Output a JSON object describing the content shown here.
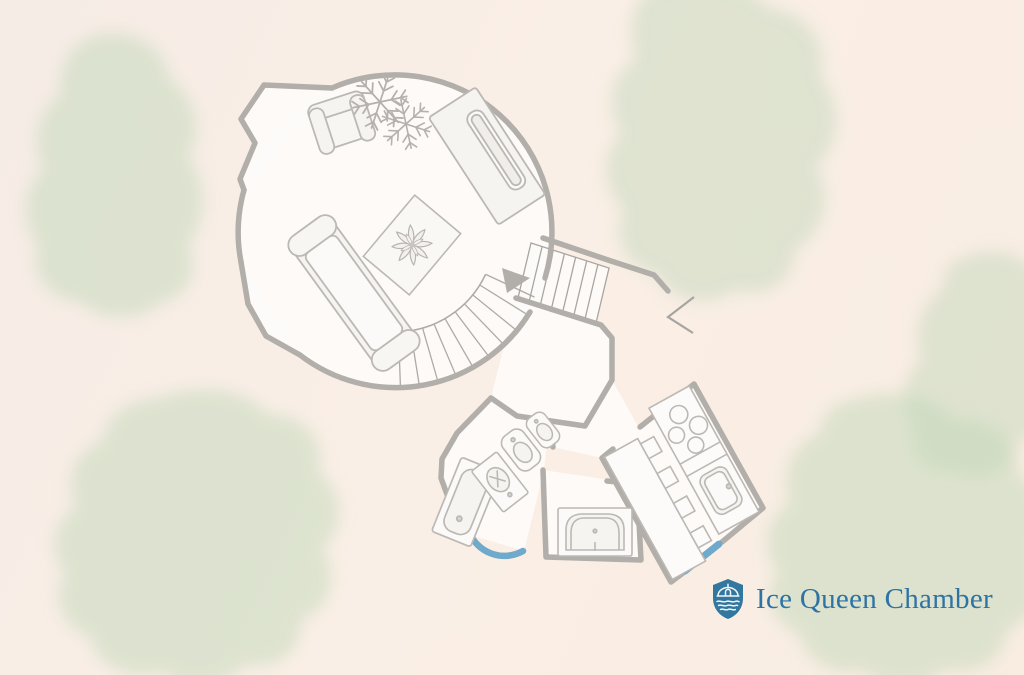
{
  "branding": {
    "logo_text": "Ice Queen Chamber",
    "logo_icon": "shield-house-crest-icon",
    "logo_text_color": "#2d73a3",
    "logo_shield_color": "#32779f"
  },
  "floor_plan": {
    "name": "Ice Queen Chamber floor plan",
    "style": "hand-drawn architectural sketch with watercolor foliage background",
    "rooms": [
      {
        "name": "main-circular-chamber",
        "shape": "circle",
        "furniture": [
          "armchair",
          "double-snowflake-decoration",
          "bed-with-runner",
          "diamond-area-rug-with-poinsettia",
          "chaise-sofa",
          "curved-staircase"
        ]
      },
      {
        "name": "entry-vestibule",
        "shape": "angular-alcove",
        "furniture": []
      },
      {
        "name": "entry-hall",
        "shape": "irregular-pentagon",
        "furniture": [
          "straight-staircase",
          "entry-door-swing"
        ]
      },
      {
        "name": "bathroom",
        "furniture": [
          "shower",
          "vanity-sink",
          "toilet",
          "bidet"
        ]
      },
      {
        "name": "bath-nook",
        "furniture": [
          "bathtub"
        ]
      },
      {
        "name": "kitchen",
        "furniture": [
          "four-burner-stove",
          "kitchen-sink",
          "prep-counter-with-cabinet-handles"
        ]
      }
    ],
    "markers": [
      "stair-direction-arrow",
      "blue-door-swing-bathroom",
      "blue-doorway-kitchen"
    ],
    "colors": {
      "wall": "#b2aeaa",
      "furniture_line": "#bcb8b4",
      "room_fill": "#fdfcfa",
      "door_accent_blue": "#6fa9cb",
      "watercolor_green": "#c4d8bc",
      "background_cream": "#f8ede4"
    }
  }
}
